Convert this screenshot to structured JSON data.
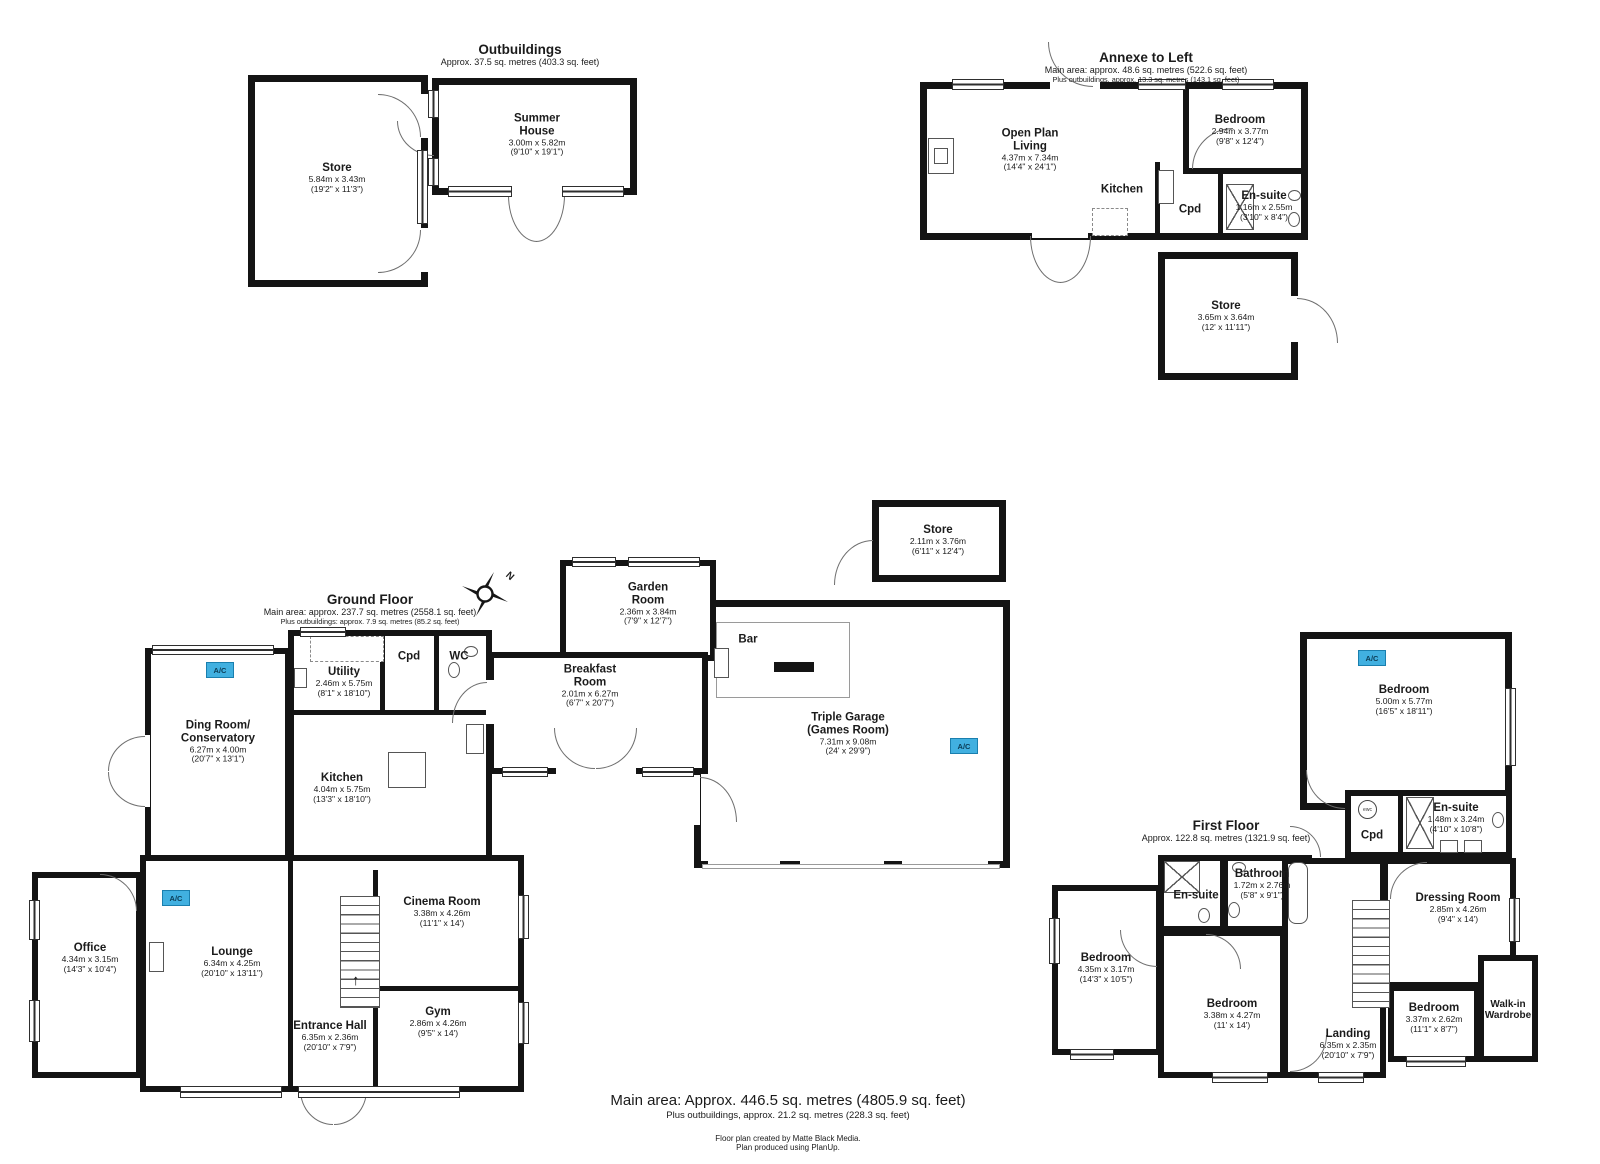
{
  "ac_label": "A/C",
  "stairs_arrow": "↑",
  "outbuildings": {
    "title": "Outbuildings",
    "subtitle": "Approx. 37.5 sq. metres (403.3 sq. feet)",
    "rooms": {
      "store": {
        "name": "Store",
        "m": "5.84m x 3.43m",
        "ft": "(19'2\" x 11'3\")"
      },
      "summer_house": {
        "name": "Summer House",
        "m": "3.00m x 5.82m",
        "ft": "(9'10\" x 19'1\")"
      }
    }
  },
  "annexe": {
    "title": "Annexe to Left",
    "subtitle": "Main area: approx. 48.6 sq. metres (522.6 sq. feet)",
    "subtitle2": "Plus outbuildings, approx. 13.3 sq. metres (143.1 sq. feet)",
    "rooms": {
      "open_plan_living": {
        "name": "Open Plan Living",
        "m": "4.37m x 7.34m",
        "ft": "(14'4\" x 24'1\")"
      },
      "bedroom": {
        "name": "Bedroom",
        "m": "2.94m x 3.77m",
        "ft": "(9'8\" x 12'4\")"
      },
      "kitchen": {
        "name": "Kitchen"
      },
      "cpd": {
        "name": "Cpd"
      },
      "ensuite": {
        "name": "En-suite",
        "m": "1.16m x 2.55m",
        "ft": "(3'10\" x 8'4\")"
      },
      "store": {
        "name": "Store",
        "m": "3.65m x 3.64m",
        "ft": "(12' x 11'11\")"
      }
    }
  },
  "ground_floor": {
    "title": "Ground Floor",
    "subtitle": "Main area: approx. 237.7 sq. metres (2558.1 sq. feet)",
    "subtitle2": "Plus outbuildings: approx. 7.9 sq. metres (85.2 sq. feet)",
    "compass_label": "N",
    "rooms": {
      "utility": {
        "name": "Utility",
        "m": "2.46m x 5.75m",
        "ft": "(8'1\" x 18'10\")"
      },
      "cpd": {
        "name": "Cpd"
      },
      "wc": {
        "name": "WC"
      },
      "dining_conservatory": {
        "name": "Ding Room/ Conservatory",
        "m": "6.27m x 4.00m",
        "ft": "(20'7\" x 13'1\")"
      },
      "kitchen": {
        "name": "Kitchen",
        "m": "4.04m x 5.75m",
        "ft": "(13'3\" x 18'10\")"
      },
      "breakfast": {
        "name": "Breakfast Room",
        "m": "2.01m x 6.27m",
        "ft": "(6'7\" x 20'7\")"
      },
      "garden": {
        "name": "Garden Room",
        "m": "2.36m x 3.84m",
        "ft": "(7'9\" x 12'7\")"
      },
      "bar": {
        "name": "Bar"
      },
      "garage": {
        "name": "Triple Garage (Games Room)",
        "m": "7.31m x 9.08m",
        "ft": "(24' x 29'9\")"
      },
      "store": {
        "name": "Store",
        "m": "2.11m x 3.76m",
        "ft": "(6'11\" x 12'4\")"
      },
      "office": {
        "name": "Office",
        "m": "4.34m x 3.15m",
        "ft": "(14'3\" x 10'4\")"
      },
      "lounge": {
        "name": "Lounge",
        "m": "6.34m x 4.25m",
        "ft": "(20'10\" x 13'11\")"
      },
      "cinema": {
        "name": "Cinema Room",
        "m": "3.38m x 4.26m",
        "ft": "(11'1\" x 14')"
      },
      "gym": {
        "name": "Gym",
        "m": "2.86m x 4.26m",
        "ft": "(9'5\" x 14')"
      },
      "entrance": {
        "name": "Entrance Hall",
        "m": "6.35m x 2.36m",
        "ft": "(20'10\" x 7'9\")"
      }
    }
  },
  "first_floor": {
    "title": "First Floor",
    "subtitle": "Approx. 122.8 sq. metres (1321.9 sq. feet)",
    "rooms": {
      "bedroom1": {
        "name": "Bedroom",
        "m": "5.00m x 5.77m",
        "ft": "(16'5\" x 18'11\")"
      },
      "ensuite": {
        "name": "En-suite",
        "m": "1.48m x 3.24m",
        "ft": "(4'10\" x 10'8\")"
      },
      "cpd": {
        "name": "Cpd",
        "badge": "ewc"
      },
      "dressing": {
        "name": "Dressing Room",
        "m": "2.85m x 4.26m",
        "ft": "(9'4\" x 14')"
      },
      "walkin": {
        "name": "Walk-in Wardrobe"
      },
      "bedroom2": {
        "name": "Bedroom",
        "m": "3.37m x 2.62m",
        "ft": "(11'1\" x 8'7\")"
      },
      "landing": {
        "name": "Landing",
        "m": "6.35m x 2.35m",
        "ft": "(20'10\" x 7'9\")"
      },
      "bedroom3": {
        "name": "Bedroom",
        "m": "3.38m x 4.27m",
        "ft": "(11' x 14')"
      },
      "bedroom4": {
        "name": "Bedroom",
        "m": "4.35m x 3.17m",
        "ft": "(14'3\" x 10'5\")"
      },
      "ensuite2": {
        "name": "En-suite"
      },
      "bathroom": {
        "name": "Bathroom",
        "m": "1.72m x 2.76m",
        "ft": "(5'8\" x 9'1\")"
      }
    }
  },
  "footer": {
    "main": "Main area: Approx. 446.5 sq. metres (4805.9 sq. feet)",
    "sub": "Plus outbuildings, approx. 21.2 sq. metres (228.3 sq. feet)",
    "credit1": "Floor plan created by Matte Black Media.",
    "credit2": "Plan produced using PlanUp."
  }
}
